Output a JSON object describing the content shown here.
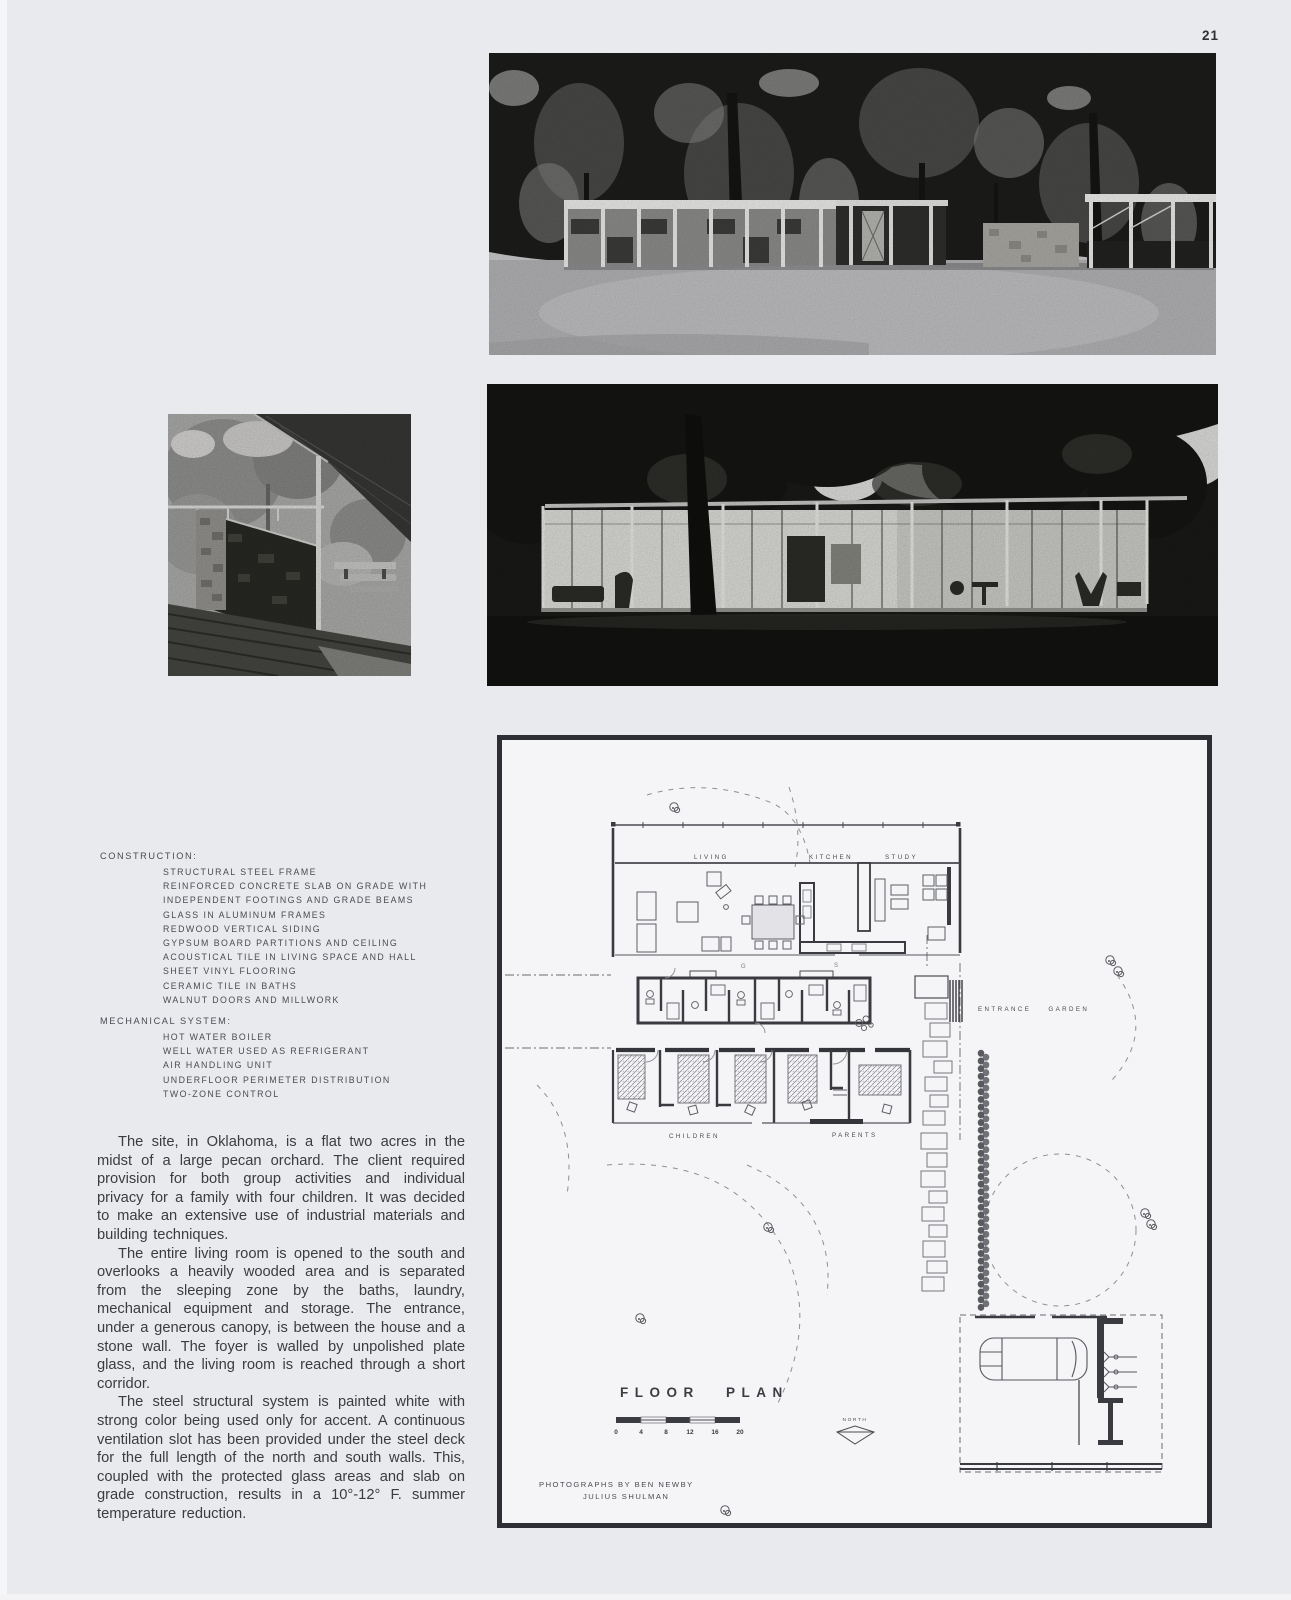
{
  "page": {
    "number": "21"
  },
  "photos": {
    "exterior_day": {
      "alt": "modular steel house among pecan trees with lawn foreground"
    },
    "exterior_dusk": {
      "alt": "glass-walled pavilion illuminated at dusk beneath dark trees"
    },
    "entrance": {
      "alt": "entrance canopy, white steel post and stone wall"
    }
  },
  "specs": {
    "construction": {
      "heading": "CONSTRUCTION:",
      "items": [
        "STRUCTURAL STEEL FRAME",
        "REINFORCED CONCRETE SLAB ON GRADE WITH",
        "INDEPENDENT FOOTINGS AND GRADE BEAMS",
        "GLASS IN ALUMINUM FRAMES",
        "REDWOOD VERTICAL SIDING",
        "GYPSUM BOARD PARTITIONS AND CEILING",
        "ACOUSTICAL TILE IN LIVING SPACE AND HALL",
        "SHEET VINYL FLOORING",
        "CERAMIC TILE IN BATHS",
        "WALNUT DOORS AND MILLWORK"
      ]
    },
    "mechanical": {
      "heading": "MECHANICAL SYSTEM:",
      "items": [
        "HOT WATER BOILER",
        "WELL WATER USED AS REFRIGERANT",
        "AIR HANDLING UNIT",
        "UNDERFLOOR PERIMETER DISTRIBUTION",
        "TWO-ZONE CONTROL"
      ]
    }
  },
  "article": {
    "paragraphs": [
      "The site, in Oklahoma, is a flat two acres in the midst of a large pecan orchard. The client required provision for both group activities and individual privacy for a family with four children. It was decided to make an extensive use of industrial materials and building techniques.",
      "The entire living room is opened to the south and overlooks a heavily wooded area and is separated from the sleeping zone by the baths, laundry, mechanical equipment and storage. The entrance, under a generous canopy, is between the house and a stone wall. The foyer is walled by unpolished plate glass, and the living room is reached through a short corridor.",
      "The steel structural system is painted white with strong color being used only for accent. A continuous ventilation slot has been provided under the steel deck for the full length of the north and south walls. This, coupled with the protected glass areas and slab on grade construction, results in a 10°-12° F. summer temperature reduction."
    ]
  },
  "floor_plan": {
    "title": "FLOOR PLAN",
    "north_label": "NORTH",
    "scale_numbers": [
      "0",
      "4",
      "8",
      "12",
      "16",
      "20"
    ],
    "rooms": {
      "living": "LIVING",
      "kitchen": "KITCHEN",
      "study": "STUDY",
      "children": "CHILDREN",
      "parents": "PARENTS",
      "entrance_garden": "ENTRANCE GARDEN"
    },
    "annotations": {
      "mark_g": "G",
      "mark_s": "S"
    },
    "credits": [
      "PHOTOGRAPHS BY BEN NEWBY",
      "JULIUS SHULMAN"
    ]
  }
}
